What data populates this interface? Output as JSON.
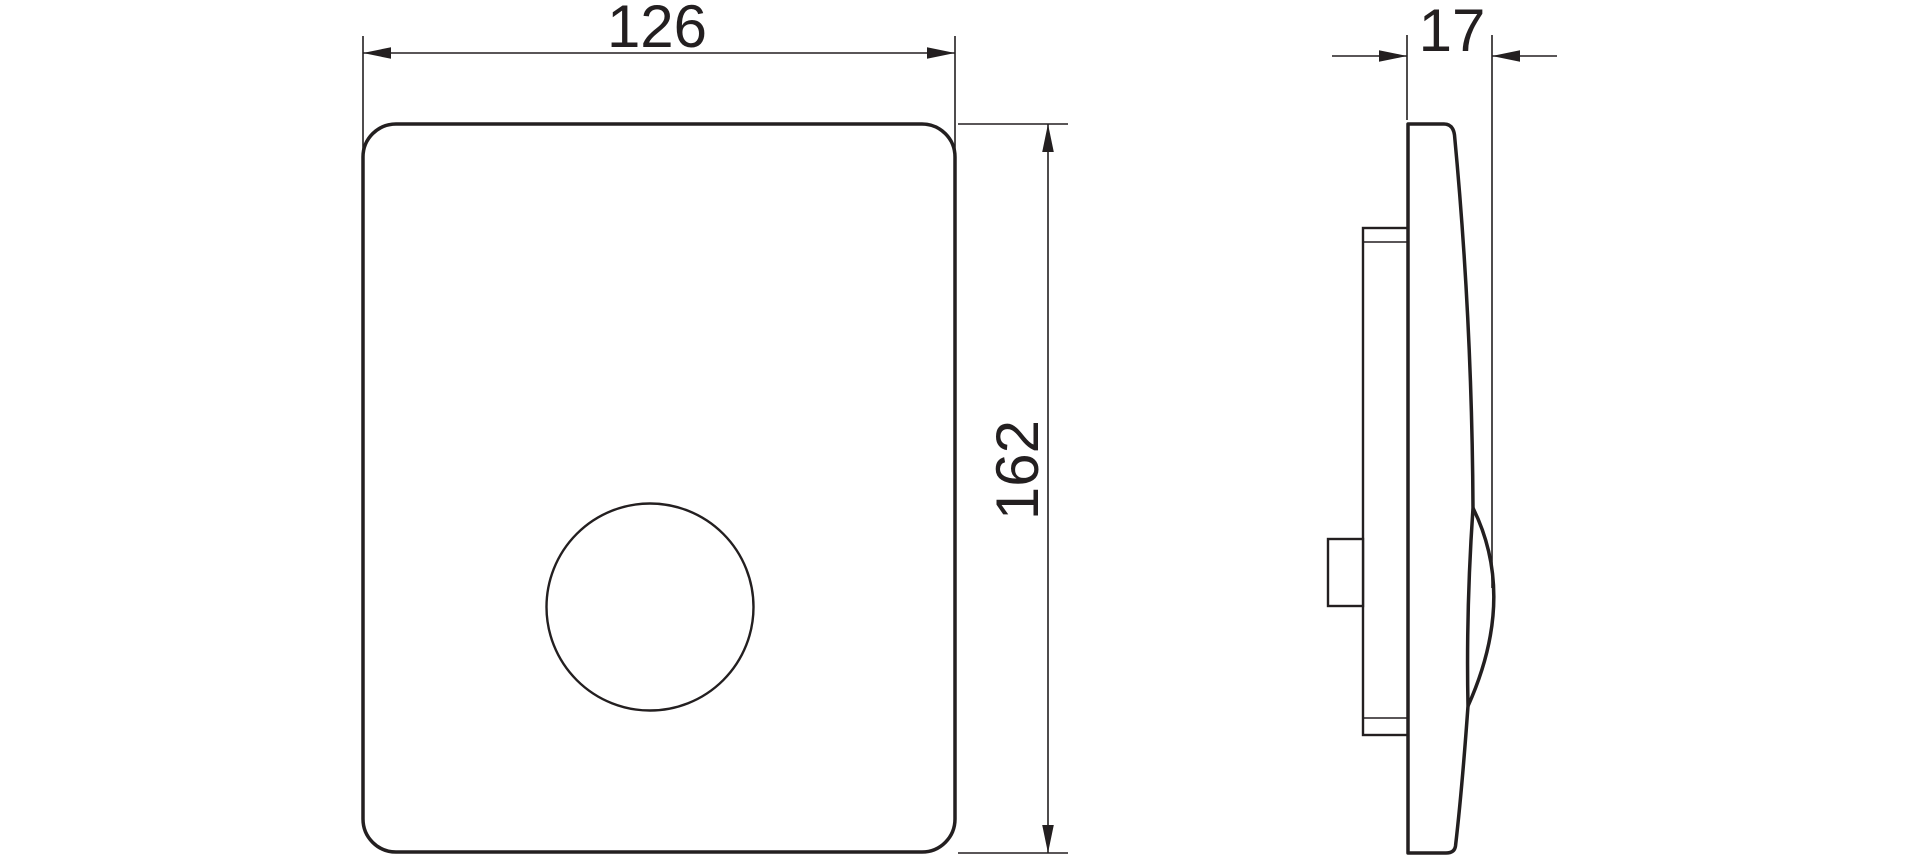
{
  "drawing": {
    "title": "flush-plate-dimension-drawing",
    "front_view": {
      "width_dimension_label": "126",
      "height_dimension_label": "162"
    },
    "side_view": {
      "depth_dimension_label": "17"
    }
  },
  "colors": {
    "line": "#231f20",
    "background": "#ffffff"
  }
}
